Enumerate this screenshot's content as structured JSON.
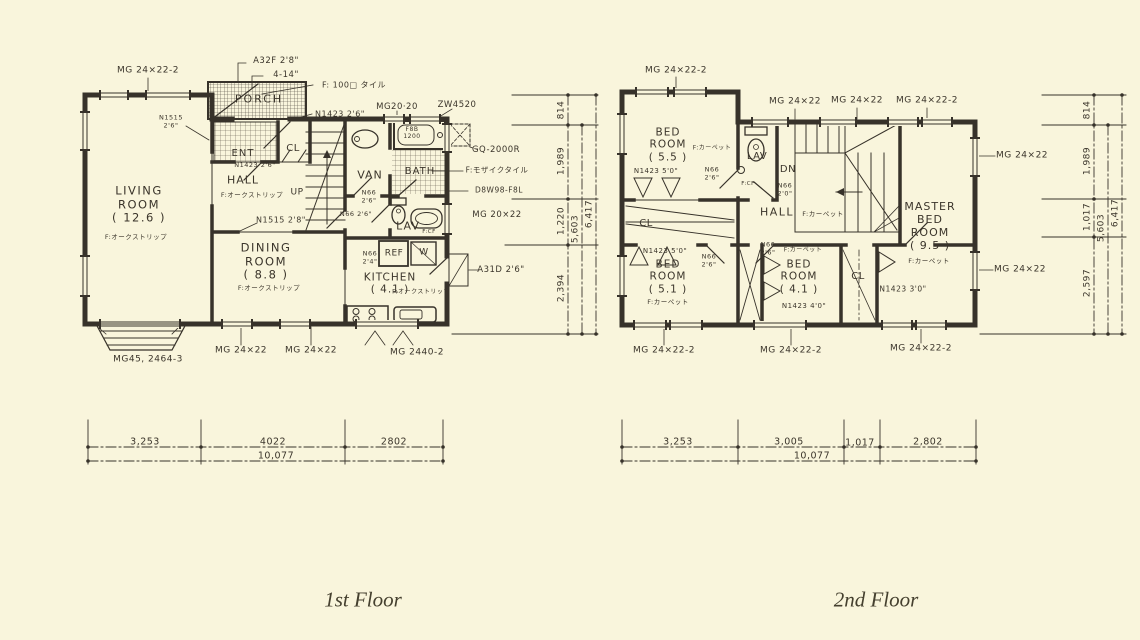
{
  "canvas": {
    "background": "#f9f5dc",
    "ink": "#37322a"
  },
  "captions": {
    "first": {
      "text": "1st Floor"
    },
    "second": {
      "text": "2nd Floor"
    }
  },
  "floor1": {
    "labels": [
      {
        "id": "mg-24x22-2-topleft-1f",
        "text": "MG 24×22-2",
        "x": 148,
        "y": 71,
        "fs": 9
      },
      {
        "id": "a32f-2-8",
        "text": "A32F 2'8\"",
        "x": 276,
        "y": 61,
        "fs": 8.5
      },
      {
        "id": "dim-4-14",
        "text": "4-14\"",
        "x": 286,
        "y": 75,
        "fs": 8.5
      },
      {
        "id": "f-100-tile",
        "text": "F: 100□ タイル",
        "x": 354,
        "y": 85,
        "fs": 8
      },
      {
        "id": "porch",
        "text": "PORCH",
        "x": 259,
        "y": 100,
        "fs": 11,
        "ls": 2
      },
      {
        "id": "n1423-2-6-porch",
        "text": "N1423 2'6\"",
        "x": 340,
        "y": 114,
        "fs": 8
      },
      {
        "id": "mg-20-20",
        "text": "MG20·20",
        "x": 397,
        "y": 107,
        "fs": 8.5
      },
      {
        "id": "zw4520",
        "text": "ZW4520",
        "x": 457,
        "y": 105,
        "fs": 8.5
      },
      {
        "id": "ent",
        "text": "ENT",
        "x": 243,
        "y": 154,
        "fs": 10,
        "ls": 1
      },
      {
        "id": "cl-1f",
        "text": "CL",
        "x": 293,
        "y": 149,
        "fs": 10
      },
      {
        "id": "n1423-2-6-hall",
        "text": "N1423 2'6\"",
        "x": 255,
        "y": 166,
        "fs": 6.5
      },
      {
        "id": "hall-1f",
        "text": "HALL",
        "x": 243,
        "y": 181,
        "fs": 11,
        "ls": 1
      },
      {
        "id": "up",
        "text": "UP",
        "x": 297,
        "y": 193,
        "fs": 9
      },
      {
        "id": "f-oak-hall",
        "text": "F:オークストリップ",
        "x": 252,
        "y": 196,
        "fs": 6.5
      },
      {
        "id": "n1515-2-6",
        "text": "N1515\n2'6\"",
        "x": 171,
        "y": 122,
        "fs": 6.5
      },
      {
        "id": "living-room",
        "text": "LIVING\nROOM\n( 12.6 )",
        "x": 139,
        "y": 205,
        "fs": 11.5,
        "ls": 1.5
      },
      {
        "id": "f-oak-living",
        "text": "F:オークストリップ",
        "x": 136,
        "y": 238,
        "fs": 6.5
      },
      {
        "id": "n1515-2-8",
        "text": "N1515 2'8\"",
        "x": 281,
        "y": 220,
        "fs": 8
      },
      {
        "id": "van",
        "text": "VAN",
        "x": 370,
        "y": 176,
        "fs": 11,
        "ls": 1
      },
      {
        "id": "n66-2-6-van",
        "text": "N66\n2'6\"",
        "x": 369,
        "y": 197,
        "fs": 6.5
      },
      {
        "id": "f8b-1200",
        "text": "F8B\n1200",
        "x": 412,
        "y": 133,
        "fs": 6
      },
      {
        "id": "bath",
        "text": "BATH",
        "x": 420,
        "y": 172,
        "fs": 10,
        "ls": 1
      },
      {
        "id": "gq-2000r",
        "text": "GQ-2000R",
        "x": 496,
        "y": 150,
        "fs": 8.5
      },
      {
        "id": "f-mosaic-tile",
        "text": "F:モザイクタイル",
        "x": 497,
        "y": 171,
        "fs": 7.5
      },
      {
        "id": "d8w98-f8l",
        "text": "D8W98-F8L",
        "x": 499,
        "y": 191,
        "fs": 7.5
      },
      {
        "id": "mg-20x22",
        "text": "MG 20×22",
        "x": 497,
        "y": 215,
        "fs": 8.5
      },
      {
        "id": "lav-1f",
        "text": "LAV",
        "x": 408,
        "y": 227,
        "fs": 11,
        "ls": 1
      },
      {
        "id": "f-cf-lav-1f",
        "text": "F:CF",
        "x": 429,
        "y": 232,
        "fs": 5.5
      },
      {
        "id": "n66-2-6-lav",
        "text": "N66 2'6\"",
        "x": 356,
        "y": 215,
        "fs": 6.5
      },
      {
        "id": "n66-2-4",
        "text": "N66\n2'4\"",
        "x": 370,
        "y": 258,
        "fs": 6.5
      },
      {
        "id": "ref",
        "text": "REF",
        "x": 394,
        "y": 254,
        "fs": 9
      },
      {
        "id": "w-appliance",
        "text": "W",
        "x": 424,
        "y": 253,
        "fs": 9
      },
      {
        "id": "kitchen",
        "text": "KITCHEN\n( 4.1 )",
        "x": 390,
        "y": 284,
        "fs": 10.5,
        "ls": 1
      },
      {
        "id": "f-oak-kitchen",
        "text": "F:オークストリップ",
        "x": 421,
        "y": 292,
        "fs": 6
      },
      {
        "id": "dining-room",
        "text": "DINING\nROOM\n( 8.8 )",
        "x": 266,
        "y": 262,
        "fs": 11.5,
        "ls": 1.5
      },
      {
        "id": "f-oak-dining",
        "text": "F:オークストリップ",
        "x": 269,
        "y": 289,
        "fs": 6.5
      },
      {
        "id": "a31d-2-6",
        "text": "A31D 2'6\"",
        "x": 501,
        "y": 270,
        "fs": 8.5
      },
      {
        "id": "mg-2440-2",
        "text": "MG 2440-2",
        "x": 417,
        "y": 353,
        "fs": 9
      },
      {
        "id": "mg45-2464-3",
        "text": "MG45, 2464-3",
        "x": 148,
        "y": 360,
        "fs": 9
      },
      {
        "id": "mg-24x22-bottom-1",
        "text": "MG 24×22",
        "x": 241,
        "y": 351,
        "fs": 9
      },
      {
        "id": "mg-24x22-bottom-2",
        "text": "MG 24×22",
        "x": 311,
        "y": 351,
        "fs": 9
      },
      {
        "id": "dim-814-1f",
        "text": "814",
        "x": 562,
        "y": 110,
        "fs": 9,
        "rot": -90
      },
      {
        "id": "dim-1989-1f",
        "text": "1,989",
        "x": 562,
        "y": 161,
        "fs": 9,
        "rot": -90
      },
      {
        "id": "dim-1220-1f",
        "text": "1,220",
        "x": 562,
        "y": 221,
        "fs": 9,
        "rot": -90
      },
      {
        "id": "dim-2394-1f",
        "text": "2,394",
        "x": 562,
        "y": 288,
        "fs": 9,
        "rot": -90
      },
      {
        "id": "dim-5603-1f",
        "text": "5,603",
        "x": 576,
        "y": 229,
        "fs": 9,
        "rot": -90
      },
      {
        "id": "dim-6417-1f",
        "text": "6,417",
        "x": 590,
        "y": 214,
        "fs": 9,
        "rot": -90
      },
      {
        "id": "dim-3253-1f",
        "text": "3,253",
        "x": 145,
        "y": 442,
        "fs": 9.5
      },
      {
        "id": "dim-4022-1f",
        "text": "4022",
        "x": 273,
        "y": 442,
        "fs": 9.5
      },
      {
        "id": "dim-2802-1f",
        "text": "2802",
        "x": 394,
        "y": 442,
        "fs": 9.5
      },
      {
        "id": "dim-10077-1f",
        "text": "10,077",
        "x": 276,
        "y": 456,
        "fs": 9.5
      }
    ]
  },
  "floor2": {
    "labels": [
      {
        "id": "mg-24x22-2-topleft-2f",
        "text": "MG 24×22-2",
        "x": 676,
        "y": 71,
        "fs": 9
      },
      {
        "id": "mg-24x22-top-1",
        "text": "MG 24×22",
        "x": 795,
        "y": 102,
        "fs": 9
      },
      {
        "id": "mg-24x22-top-2",
        "text": "MG 24×22",
        "x": 857,
        "y": 101,
        "fs": 9
      },
      {
        "id": "mg-24x22-2-top-3",
        "text": "MG 24×22-2",
        "x": 927,
        "y": 101,
        "fs": 9
      },
      {
        "id": "bed-room-5-5",
        "text": "BED\nROOM\n( 5.5 )",
        "x": 668,
        "y": 145,
        "fs": 10.5,
        "ls": 1
      },
      {
        "id": "f-carpet-5-5",
        "text": "F:カーペット",
        "x": 712,
        "y": 148,
        "fs": 6
      },
      {
        "id": "n1423-5-0-top",
        "text": "N1423 5'0\"",
        "x": 656,
        "y": 171,
        "fs": 7
      },
      {
        "id": "n66-2-6-lav2",
        "text": "N66\n2'6\"",
        "x": 712,
        "y": 174,
        "fs": 6.5
      },
      {
        "id": "lav-2f",
        "text": "LAV",
        "x": 757,
        "y": 157,
        "fs": 10
      },
      {
        "id": "f-cf-lav-2f",
        "text": "F:CF",
        "x": 748,
        "y": 184,
        "fs": 5.5
      },
      {
        "id": "dn",
        "text": "DN",
        "x": 788,
        "y": 170,
        "fs": 10
      },
      {
        "id": "n66-2-0",
        "text": "N66\n2'0\"",
        "x": 785,
        "y": 190,
        "fs": 6.5
      },
      {
        "id": "hall-2f",
        "text": "HALL",
        "x": 777,
        "y": 213,
        "fs": 11,
        "ls": 1.5
      },
      {
        "id": "f-carpet-hall",
        "text": "F:カーペット",
        "x": 823,
        "y": 215,
        "fs": 6.5
      },
      {
        "id": "master-bed-room",
        "text": "MASTER\nBED\nROOM\n( 9.5 )",
        "x": 930,
        "y": 227,
        "fs": 11,
        "ls": 1
      },
      {
        "id": "f-carpet-master",
        "text": "F:カーペット",
        "x": 929,
        "y": 262,
        "fs": 6.5
      },
      {
        "id": "n1423-3-0",
        "text": "N1423 3'0\"",
        "x": 903,
        "y": 290,
        "fs": 7.5
      },
      {
        "id": "cl-left-2f",
        "text": "CL",
        "x": 646,
        "y": 224,
        "fs": 10
      },
      {
        "id": "n1423-5-0-mid",
        "text": "N1423 5'0\"",
        "x": 665,
        "y": 251,
        "fs": 7
      },
      {
        "id": "bed-room-5-1",
        "text": "BED\nROOM\n( 5.1 )",
        "x": 668,
        "y": 277,
        "fs": 10.5,
        "ls": 1
      },
      {
        "id": "f-carpet-5-1",
        "text": "F:カーペット",
        "x": 668,
        "y": 303,
        "fs": 6.5
      },
      {
        "id": "n66-2-6-51",
        "text": "N66\n2'6\"",
        "x": 709,
        "y": 261,
        "fs": 6.5
      },
      {
        "id": "n66-2-6-41",
        "text": "N66\n2'6\"",
        "x": 768,
        "y": 249,
        "fs": 6.5
      },
      {
        "id": "f-carpet-41",
        "text": "F:カーペット",
        "x": 803,
        "y": 250,
        "fs": 6
      },
      {
        "id": "bed-room-4-1",
        "text": "BED\nROOM\n( 4.1 )",
        "x": 799,
        "y": 277,
        "fs": 10.5,
        "ls": 1
      },
      {
        "id": "n1423-4-0",
        "text": "N1423 4'0\"",
        "x": 804,
        "y": 306,
        "fs": 7
      },
      {
        "id": "cl-right-2f",
        "text": "CL",
        "x": 858,
        "y": 277,
        "fs": 10
      },
      {
        "id": "mg-24x22-right-1",
        "text": "MG 24×22",
        "x": 1022,
        "y": 156,
        "fs": 9
      },
      {
        "id": "mg-24x22-right-2",
        "text": "MG 24×22",
        "x": 1020,
        "y": 270,
        "fs": 9
      },
      {
        "id": "mg-24x22-2-bot-1",
        "text": "MG 24×22-2",
        "x": 664,
        "y": 351,
        "fs": 9
      },
      {
        "id": "mg-24x22-2-bot-2",
        "text": "MG 24×22-2",
        "x": 791,
        "y": 351,
        "fs": 9
      },
      {
        "id": "mg-24x22-2-bot-3",
        "text": "MG 24×22-2",
        "x": 921,
        "y": 349,
        "fs": 9
      },
      {
        "id": "dim-814-2f",
        "text": "814",
        "x": 1088,
        "y": 110,
        "fs": 9,
        "rot": -90
      },
      {
        "id": "dim-1989-2f",
        "text": "1,989",
        "x": 1088,
        "y": 161,
        "fs": 9,
        "rot": -90
      },
      {
        "id": "dim-1017-2f",
        "text": "1,017",
        "x": 1088,
        "y": 217,
        "fs": 9,
        "rot": -90
      },
      {
        "id": "dim-2597-2f",
        "text": "2,597",
        "x": 1088,
        "y": 283,
        "fs": 9,
        "rot": -90
      },
      {
        "id": "dim-5603-2f",
        "text": "5,603",
        "x": 1102,
        "y": 228,
        "fs": 9,
        "rot": -90
      },
      {
        "id": "dim-6417-2f",
        "text": "6,417",
        "x": 1116,
        "y": 213,
        "fs": 9,
        "rot": -90
      },
      {
        "id": "dim-3253-2f",
        "text": "3,253",
        "x": 678,
        "y": 442,
        "fs": 9.5
      },
      {
        "id": "dim-3005-2f",
        "text": "3,005",
        "x": 789,
        "y": 442,
        "fs": 9.5
      },
      {
        "id": "dim-1017b-2f",
        "text": "1,017",
        "x": 860,
        "y": 443,
        "fs": 9.5
      },
      {
        "id": "dim-2802-2f",
        "text": "2,802",
        "x": 928,
        "y": 442,
        "fs": 9.5
      },
      {
        "id": "dim-10077-2f",
        "text": "10,077",
        "x": 812,
        "y": 456,
        "fs": 9.5
      }
    ]
  }
}
